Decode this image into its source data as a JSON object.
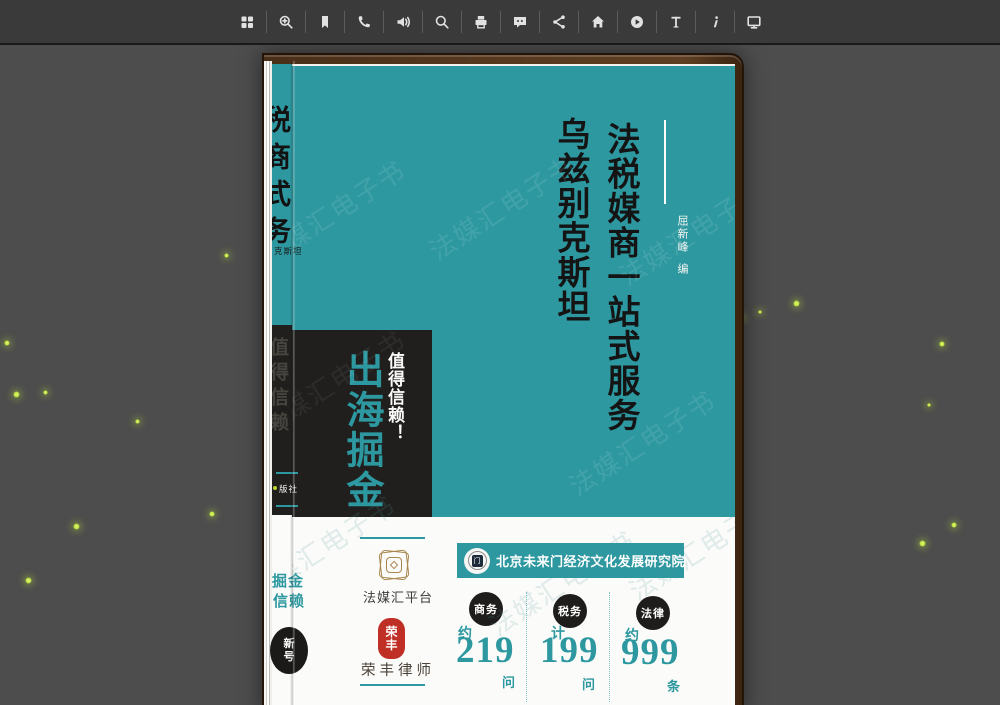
{
  "toolbar": {
    "icons": [
      "thumbnails",
      "zoom-in",
      "bookmark",
      "phone",
      "volume",
      "search",
      "print",
      "chat",
      "share",
      "home",
      "play",
      "text",
      "info",
      "display"
    ]
  },
  "background": {
    "color": "#4d4d4d",
    "firefly_color": "#c0e63e",
    "fireflies": [
      [
        226,
        255,
        5
      ],
      [
        7,
        343,
        6
      ],
      [
        16,
        394,
        7
      ],
      [
        45,
        392,
        5
      ],
      [
        137,
        421,
        5
      ],
      [
        212,
        514,
        6
      ],
      [
        76,
        526,
        7
      ],
      [
        28,
        580,
        7
      ],
      [
        796,
        303,
        7
      ],
      [
        760,
        312,
        4
      ],
      [
        741,
        318,
        6
      ],
      [
        942,
        344,
        6
      ],
      [
        929,
        405,
        4
      ],
      [
        954,
        525,
        6
      ],
      [
        922,
        543,
        7
      ]
    ]
  },
  "watermark": {
    "text": "法媒汇电子书"
  },
  "book": {
    "cover": {
      "title_line1": "法税媒商一站式服务",
      "title_line2": "乌兹别克斯坦",
      "author_name": "屈新峰",
      "author_role": "编",
      "slogan_main": "出海掘金",
      "slogan_sub": "值得信赖！"
    },
    "spine_edge": {
      "title_fragment": "税商式务",
      "region_fragment": "克斯坦",
      "slogan_fragment": "值得信赖",
      "publisher_fragment": "版社",
      "band_fragment_line1": "掘金",
      "band_fragment_line2": "信赖",
      "badge_line1": "新",
      "badge_line2": "号"
    },
    "band": {
      "platform_logo_label": "法媒汇平台",
      "seal_text_line1": "荣",
      "seal_text_line2": "丰",
      "lawfirm_label": "荣丰律师",
      "institute_logo_glyph": "门",
      "institute_name": "北京未来门经济文化发展研究院",
      "stats": [
        {
          "category": "商务",
          "prefix": "约",
          "value": "219",
          "unit": "问"
        },
        {
          "category": "税务",
          "prefix": "计",
          "value": "199",
          "unit": "问"
        },
        {
          "category": "法律",
          "prefix": "约",
          "value": "999",
          "unit": "条"
        }
      ]
    },
    "colors": {
      "cover_teal": "#2d98a0",
      "box_black": "#201f1d",
      "stat_number": "#2d98a0",
      "gold": "#a8874e",
      "seal_red": "#bf2f26",
      "frame_brown": "#54371e",
      "background": "#4d4d4d",
      "toolbar": "#3a3a3a",
      "firefly": "#c0e63e"
    }
  }
}
